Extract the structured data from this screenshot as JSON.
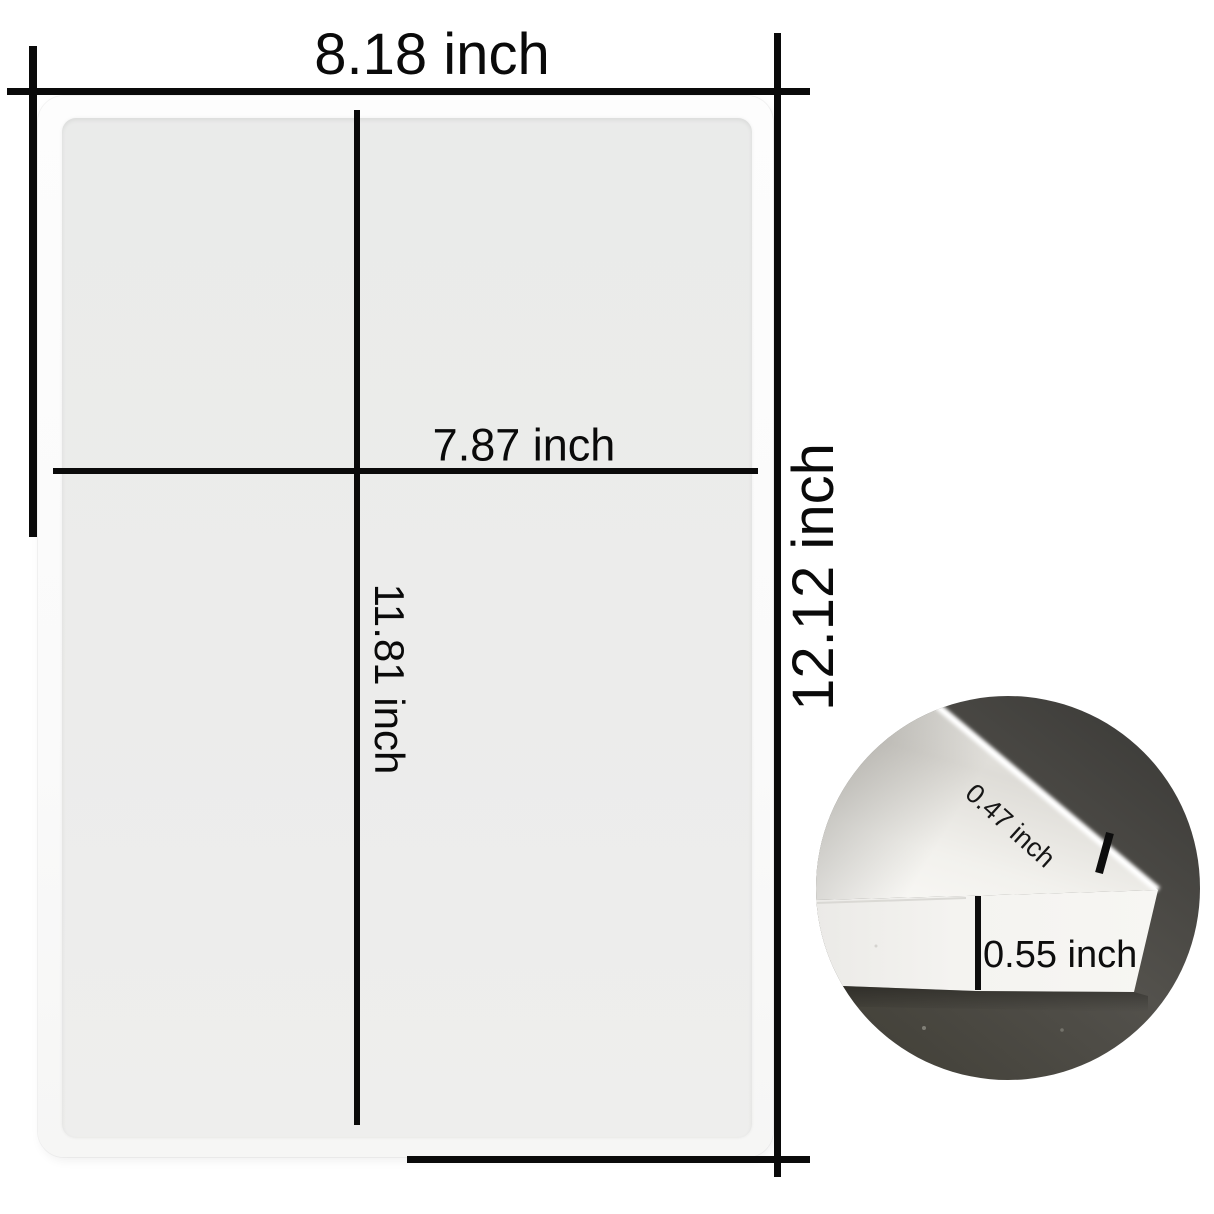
{
  "image_type": "product dimension diagram of a rectangular silicone tray mold",
  "labels": {
    "outer_width": "8.18 inch",
    "inner_width": "7.87 inch",
    "inner_height": "11.81 inch",
    "outer_height": "12.12 inch",
    "rim_thickness": "0.47 inch",
    "wall_height": "0.55 inch"
  },
  "colors": {
    "background": "#ffffff",
    "dimension_lines": "#0a0a0a",
    "label_text": "#0a0a0a",
    "tray_rim_white": "#fbfbfb",
    "tray_floor_gray": "#ebeceb",
    "inset_floor_dark": "#46443f",
    "inset_mold_white": "#f4f3f0"
  }
}
